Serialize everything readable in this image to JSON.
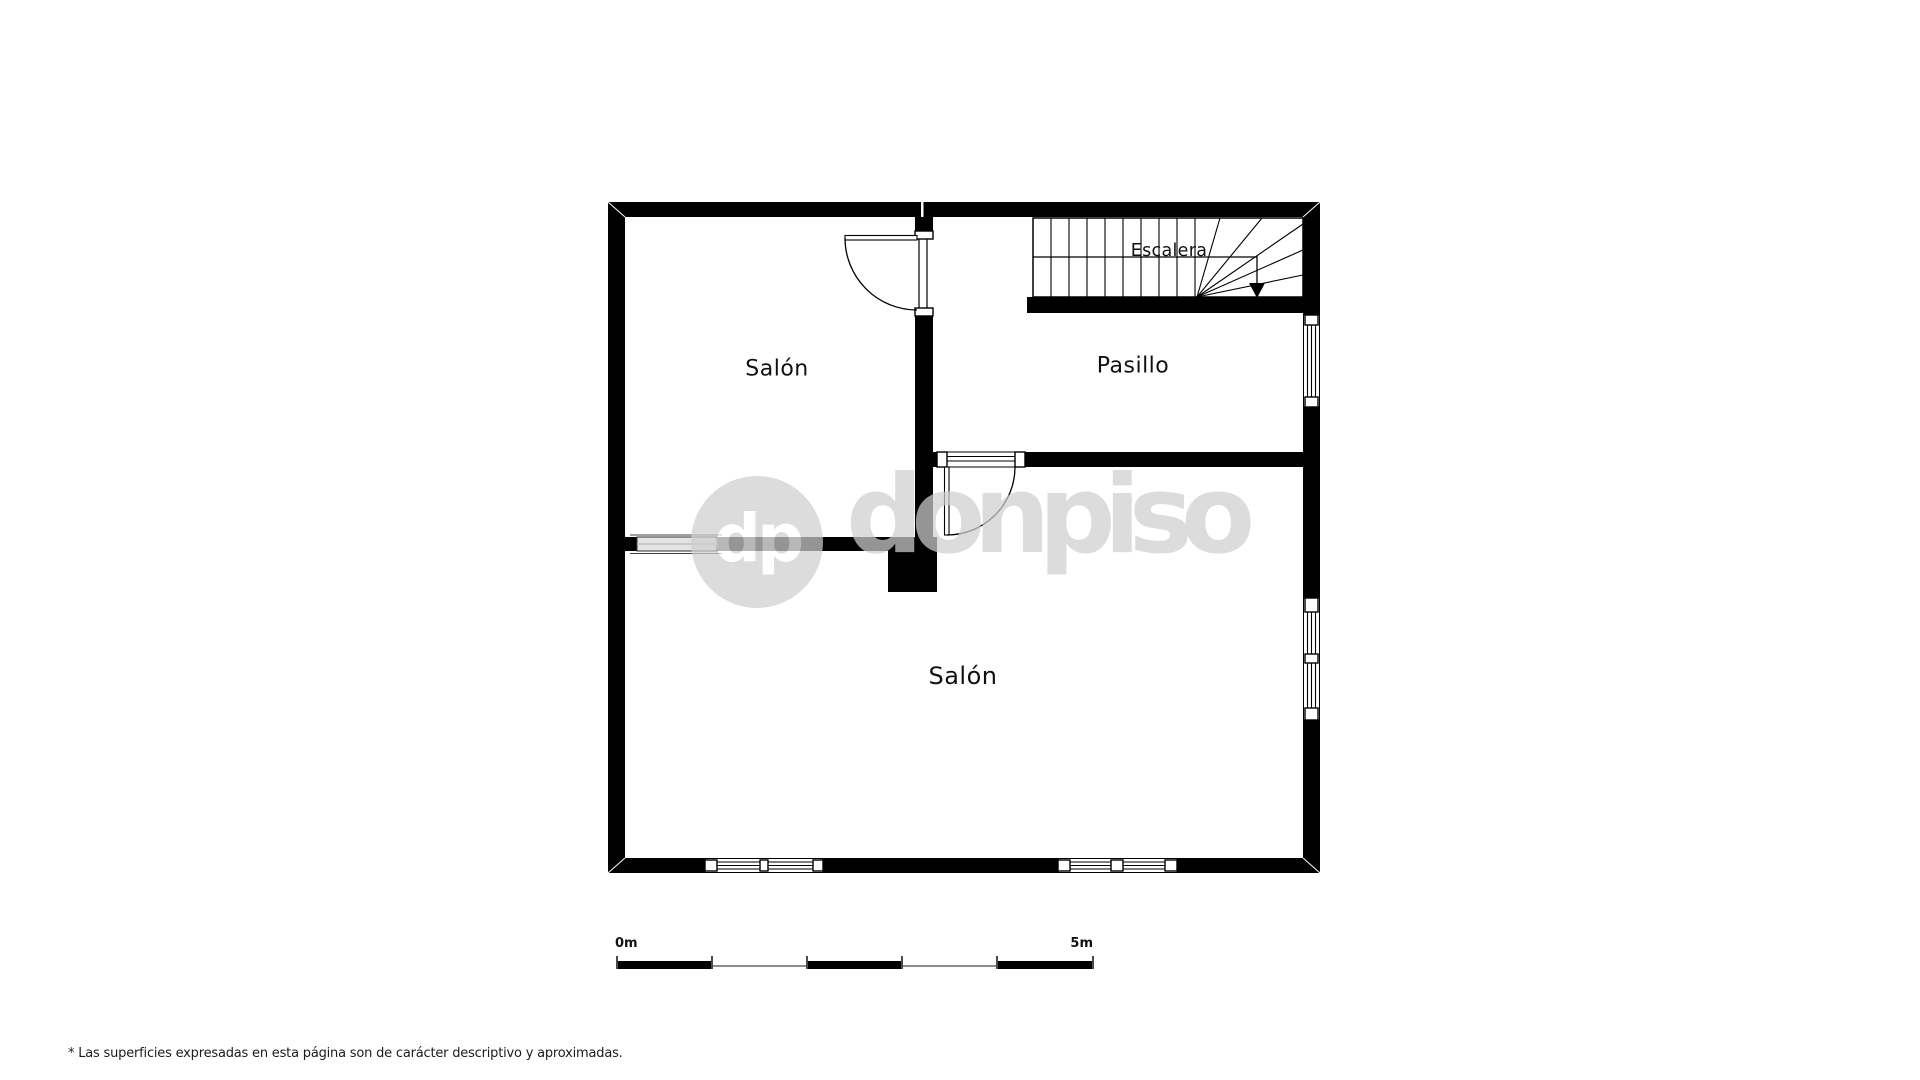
{
  "rooms": {
    "salon_top": "Salón",
    "pasillo": "Pasillo",
    "salon_bottom": "Salón"
  },
  "stairs": {
    "label": "Escalera"
  },
  "watermark": {
    "badge_text": "dp",
    "brand_text": "donpiso"
  },
  "scale_bar": {
    "start_label": "0m",
    "end_label": "5m",
    "segments": 5,
    "meters_per_segment": 1
  },
  "footnote": {
    "text": "* Las superficies expresadas en esta página son de carácter descriptivo y aproximadas."
  },
  "colors": {
    "wall": "#000000",
    "background": "#ffffff",
    "watermark_gray": "#cfcfcf",
    "scale_gray": "#8c8c8c"
  }
}
